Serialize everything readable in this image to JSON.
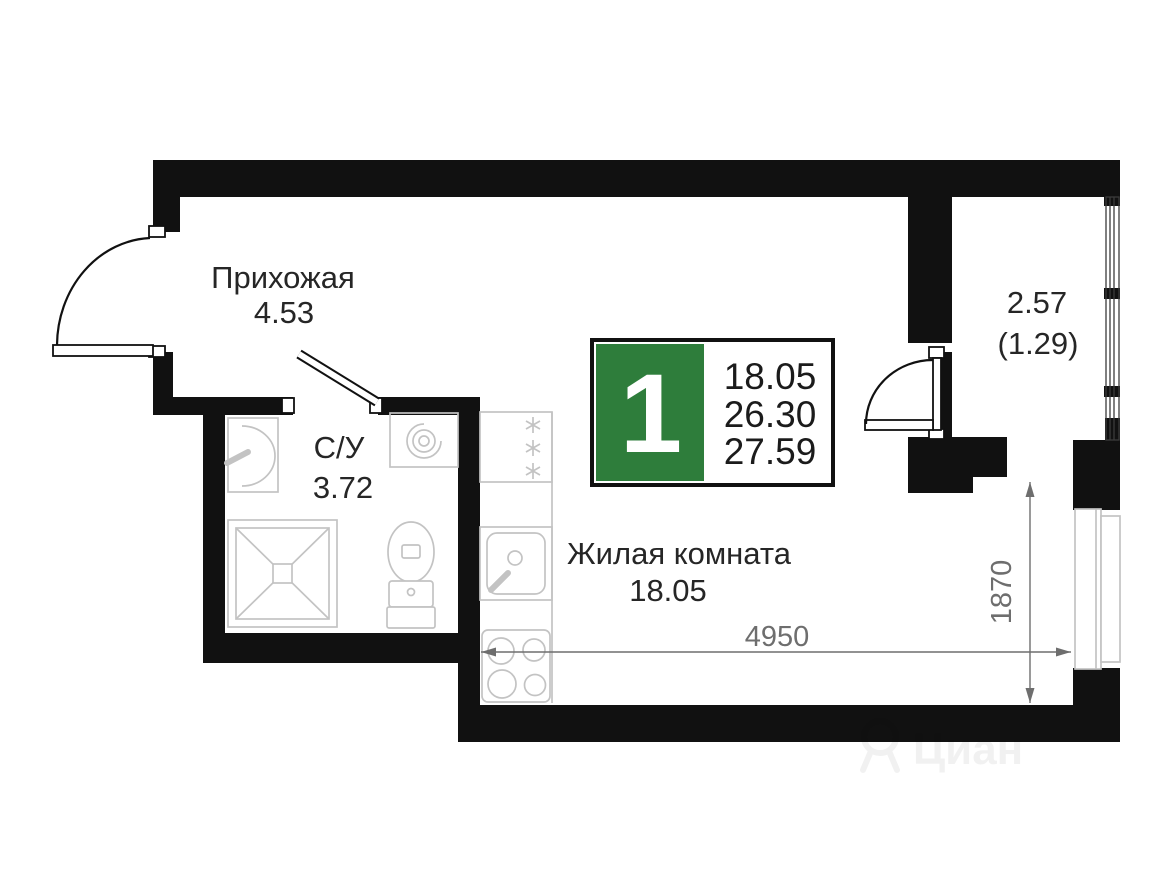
{
  "plan": {
    "rooms": {
      "hallway": {
        "name": "Прихожая",
        "area": "4.53"
      },
      "bathroom": {
        "name": "С/У",
        "area": "3.72"
      },
      "living": {
        "name": "Жилая комната",
        "area": "18.05"
      },
      "balcony": {
        "area": "2.57",
        "area_secondary": "(1.29)"
      }
    },
    "info_badge": {
      "rooms_count": "1",
      "living_area": "18.05",
      "area_without_balcony": "26.30",
      "total_area": "27.59"
    },
    "dimensions": {
      "horizontal_mm": "4950",
      "vertical_mm": "1870"
    },
    "fixtures": [
      "fridge",
      "kitchen-sink",
      "stove",
      "washbasin",
      "washing-machine",
      "shower",
      "toilet"
    ],
    "watermark": "Циан",
    "colors": {
      "wall": "#111111",
      "fixture": "#c3c3c3",
      "dimension": "#6e6e6e",
      "label": "#262626",
      "badge_green": "#2e7d3b",
      "badge_text": "#1b1b1b"
    }
  }
}
